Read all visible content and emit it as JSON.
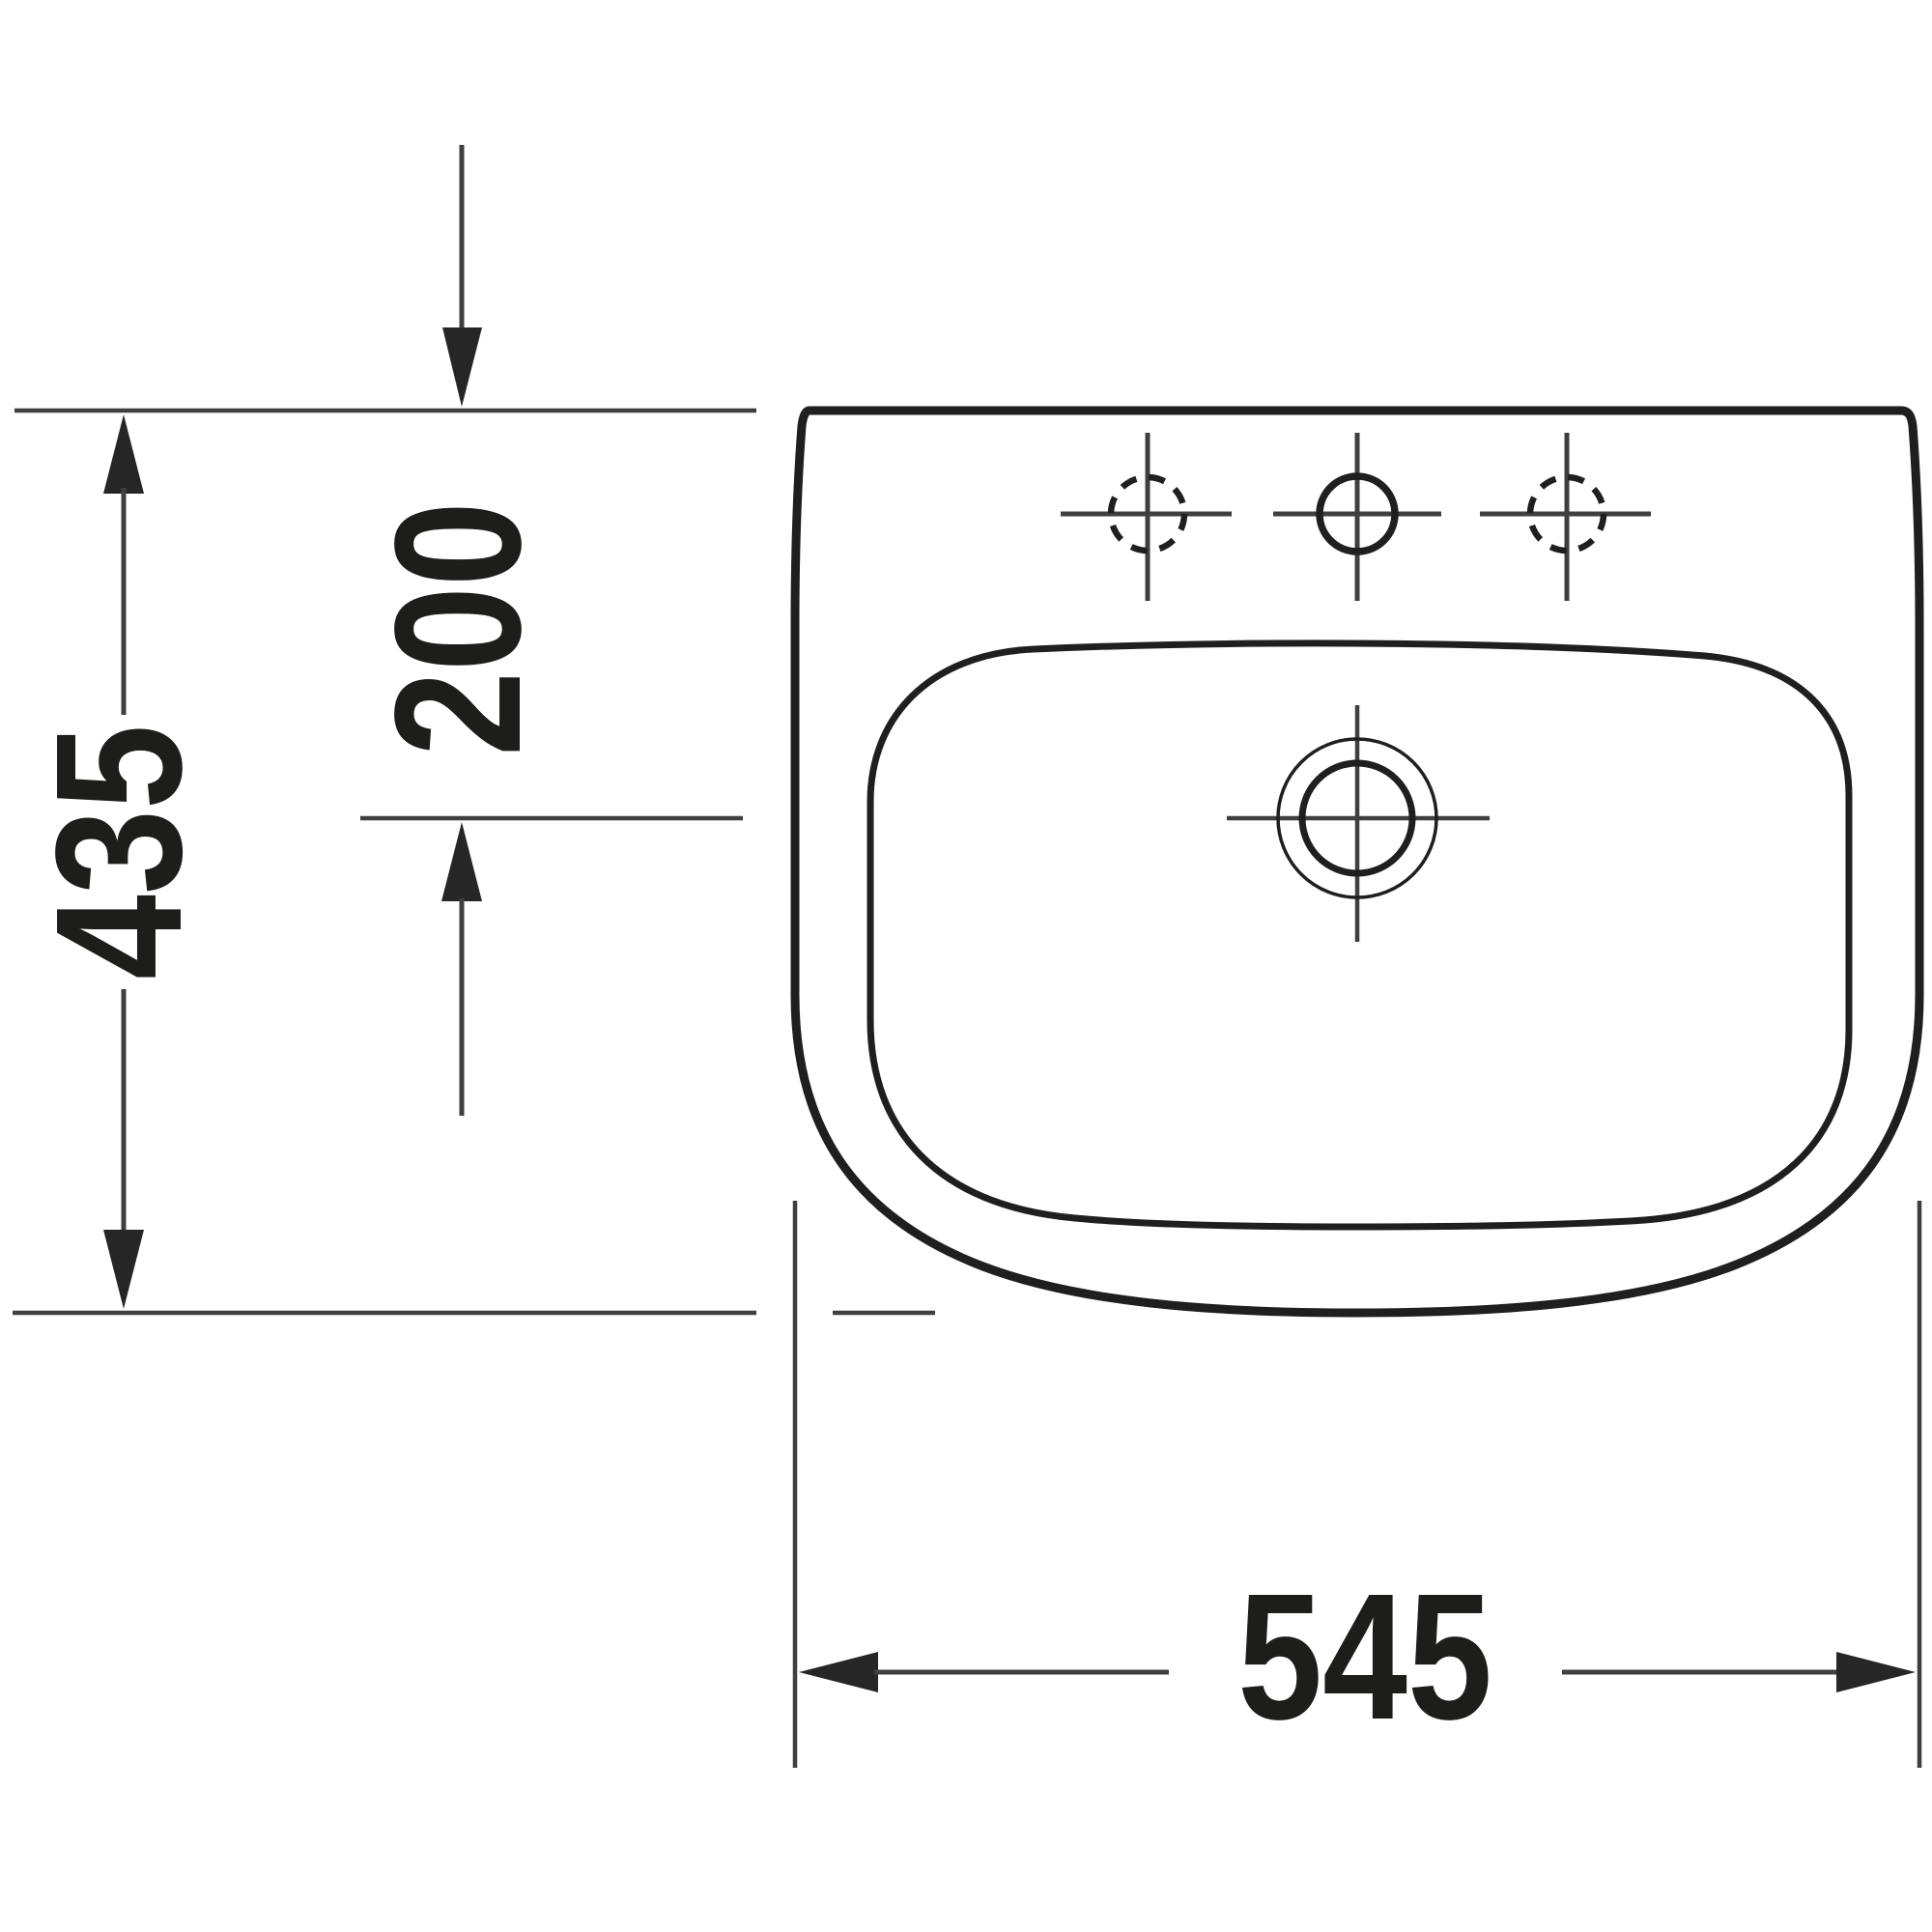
{
  "page": {
    "background_color": "#ffffff"
  },
  "drawing": {
    "kind": "washbasin-top-view-dimension-drawing",
    "colors": {
      "outline": "#1f1f1f",
      "dimension_lines": "#3f3f3f",
      "arrow_fill": "#262626",
      "text": "#1d1d1b",
      "background": "#ffffff"
    },
    "dimensions": {
      "depth": {
        "value": "435",
        "orientation": "vertical-left"
      },
      "rear_edge_to_drain": {
        "value": "200",
        "orientation": "vertical-inner"
      },
      "width": {
        "value": "545",
        "orientation": "horizontal-bottom"
      }
    },
    "features": {
      "faucet_holes": [
        {
          "name": "faucet-hole-left",
          "style": "dashed-circle-crosshair"
        },
        {
          "name": "faucet-hole-center",
          "style": "solid-circle-crosshair"
        },
        {
          "name": "faucet-hole-right",
          "style": "dashed-circle-crosshair"
        }
      ],
      "drain": {
        "name": "drain-overflow",
        "style": "concentric-circles-crosshair"
      }
    }
  }
}
